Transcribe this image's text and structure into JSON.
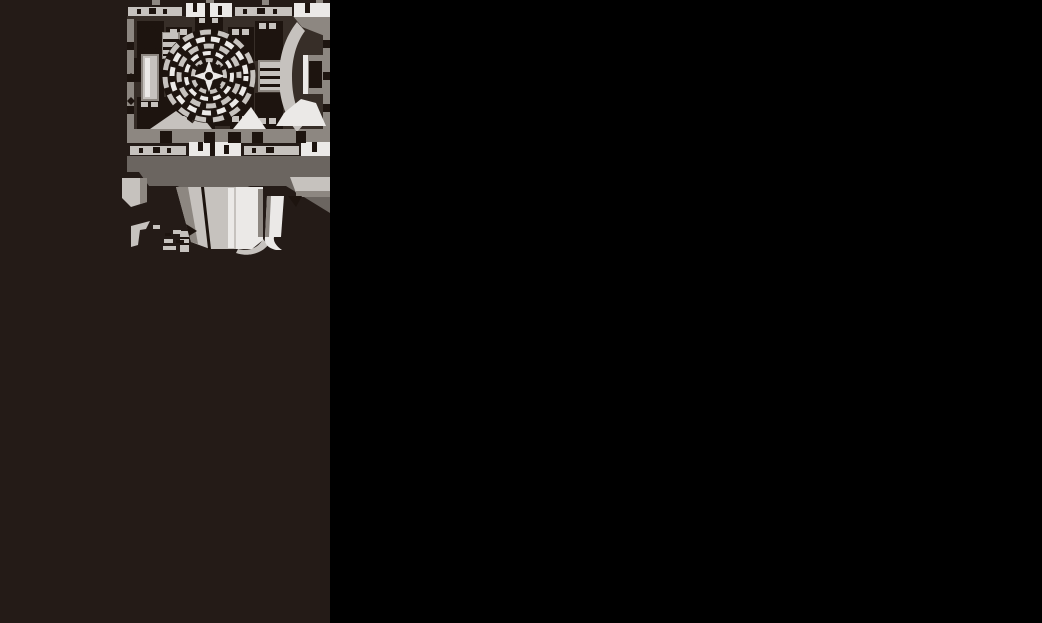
{
  "page": {
    "background_color": "#000000",
    "panel_color": "#241b17"
  },
  "illustration": {
    "name": "transmission-cutaway-drawing",
    "description": "Grayscale halftone technical cutaway drawing of a vehicle transmission unit, front view: rectangular housing with top and bottom bolt rails, central concentric torque-converter rings with a four-point star hub, side valve cylinders and blocks, C-shaped housing opening at right, and an oil pan with drain fittings below",
    "palette": {
      "darkest": "#1d140f",
      "dark": "#372e28",
      "band": "#6b6560",
      "mid": "#8d8781",
      "light": "#c6c2be",
      "bright": "#ebe9e7"
    },
    "parts": [
      {
        "name": "top-bolt-rail"
      },
      {
        "name": "housing-block"
      },
      {
        "name": "converter-rings"
      },
      {
        "name": "star-hub"
      },
      {
        "name": "corner-blocks"
      },
      {
        "name": "side-cylinders"
      },
      {
        "name": "right-c-housing"
      },
      {
        "name": "bottom-bolt-rail"
      },
      {
        "name": "pan-band"
      },
      {
        "name": "pan-walls"
      },
      {
        "name": "drain-fittings"
      },
      {
        "name": "small-brackets"
      }
    ]
  }
}
